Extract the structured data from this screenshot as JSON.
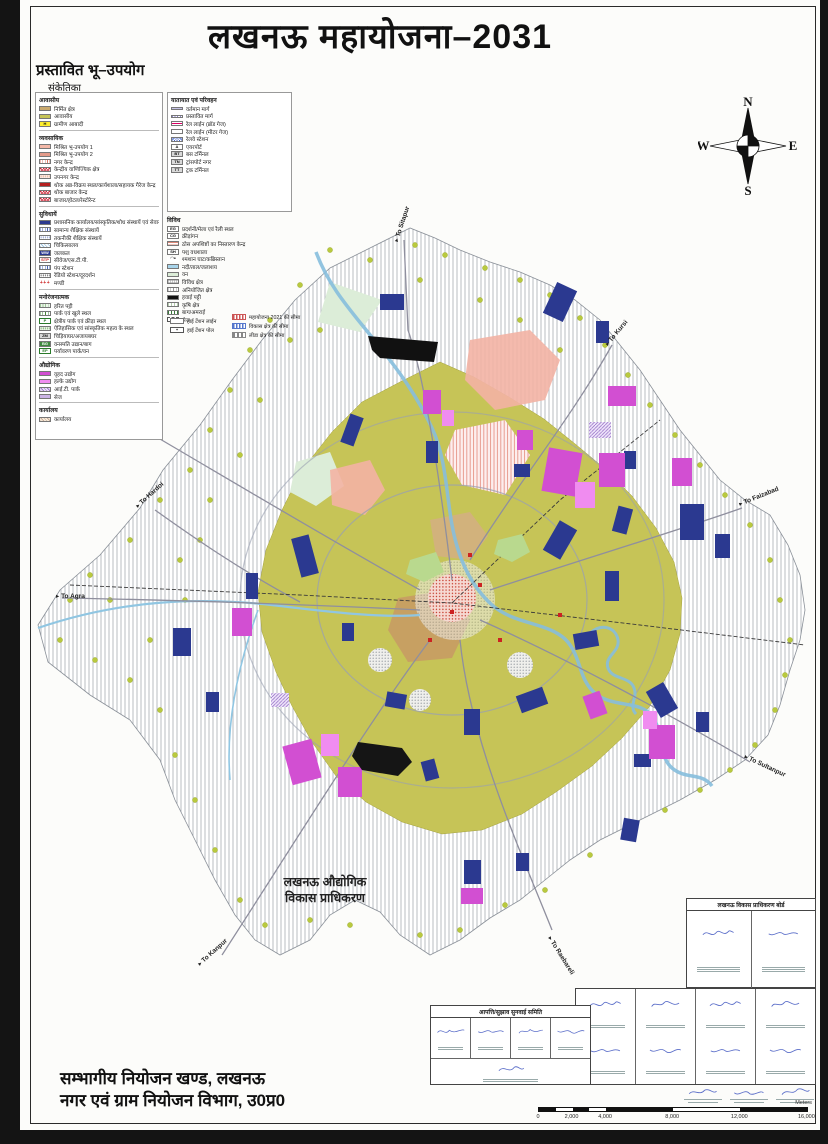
{
  "page": {
    "title": "लखनऊ महायोजना–2031",
    "subtitle": "प्रस्तावित भू–उपयोग",
    "legend_caption": "संकेतिका"
  },
  "legend_left": {
    "sections": [
      {
        "heading": "आवासीय",
        "items": [
          {
            "label": "निर्मित क्षेत्र",
            "swatch": "builtup"
          },
          {
            "label": "आवासीय",
            "swatch": "residential"
          },
          {
            "label": "ग्रामीण आबादी",
            "swatch": "lt-yellow",
            "letter": "H"
          }
        ]
      },
      {
        "heading": "व्यवसायिक",
        "items": [
          {
            "label": "मिश्रित भू-उपयोग 1",
            "swatch": "mixed1"
          },
          {
            "label": "मिश्रित भू-उपयोग 2",
            "swatch": "mixed2"
          },
          {
            "label": "नगर केन्द्र",
            "swatch": "p-hatch-pink"
          },
          {
            "label": "केन्द्रीय वाणिज्यिक क्षेत्र",
            "swatch": "p-cross-red"
          },
          {
            "label": "उपनगर केन्द्र",
            "swatch": "p-dots-pink"
          },
          {
            "label": "थोक अन्न-विक्रय स्थल/कार्यशाला/सहायक गैरेज केन्द्र",
            "swatch": "wholesale"
          },
          {
            "label": "थोक बाजार केन्द्र",
            "swatch": "p-cross-red"
          },
          {
            "label": "बाजार/होटल/रेस्टोरेन्ट",
            "swatch": "p-cross-red"
          }
        ]
      },
      {
        "heading": "सुविधायें",
        "items": [
          {
            "label": "प्रशासनिक कार्यालय/सांस्कृतिक/शोध संस्थायें एवं सेवायें",
            "swatch": "navy"
          },
          {
            "label": "सामान्य शैक्षिक संस्थायें",
            "swatch": "p-vlines-blue"
          },
          {
            "label": "तकनीकी शैक्षिक संस्थायें",
            "swatch": "p-dots-blue"
          },
          {
            "label": "चिकित्सालय",
            "swatch": "p-hatch-ltblue"
          },
          {
            "label": "जलकल",
            "swatch": "lt-navy",
            "letter": "WW"
          },
          {
            "label": "सीवेज/एस.टी.पी.",
            "swatch": "lt-stp",
            "letter": "STP"
          },
          {
            "label": "पंप स्टेशन",
            "swatch": "p-vlines-blue"
          },
          {
            "label": "रेडियो स्टेशन/दूरदर्शन",
            "swatch": "p-dots-black"
          },
          {
            "label": "मण्डी",
            "swatch": "plus-red",
            "letter": "+++"
          }
        ]
      },
      {
        "heading": "मनोरंजनात्मक",
        "items": [
          {
            "label": "हरित पट्टी",
            "swatch": "greenbelt"
          },
          {
            "label": "पार्क एवं खुले स्थल",
            "swatch": "p-vlines-green"
          },
          {
            "label": "क्षेत्रीय पार्क एवं क्रीड़ा स्थल",
            "swatch": "lt-greenb",
            "letter": "P"
          },
          {
            "label": "ऐतिहासिक एवं सांस्कृतिक महत्व के स्थल",
            "swatch": "p-dots-green"
          },
          {
            "label": "चिड़ियाघर/अजायबघर",
            "swatch": "lt-grey",
            "letter": "ZM"
          },
          {
            "label": "वनस्पति उद्यान/बाग",
            "swatch": "lt-green",
            "letter": "BG"
          },
          {
            "label": "पर्यावरण पार्क/वन",
            "swatch": "lt-greenb",
            "letter": "EP"
          }
        ]
      },
      {
        "heading": "औद्योगिक",
        "items": [
          {
            "label": "वृहद उद्योग",
            "swatch": "ind1"
          },
          {
            "label": "हल्के उद्योग",
            "swatch": "ind2"
          },
          {
            "label": "आई.टी. पार्क",
            "swatch": "p-hatch-purple"
          },
          {
            "label": "सेज",
            "swatch": "sez"
          }
        ]
      },
      {
        "heading": "कार्यालय",
        "items": [
          {
            "label": "कार्यालय",
            "swatch": "p-hatch-tan"
          }
        ]
      }
    ]
  },
  "legend_right": {
    "sections": [
      {
        "heading": "यातायात एवं परिवहन",
        "items": [
          {
            "label": "वर्तमान मार्ग",
            "swatch": "road-exist"
          },
          {
            "label": "प्रस्तावित मार्ग",
            "swatch": "road-prop"
          },
          {
            "label": "रेल लाईन (ब्रॉड गेज)",
            "swatch": "rail-broad"
          },
          {
            "label": "रेल लाईन (मीटर गेज)",
            "swatch": "rail-meter"
          },
          {
            "label": "रेलवे स्टेशन",
            "swatch": "metro-x"
          },
          {
            "label": "एयरपोर्ट",
            "swatch": "lt-white",
            "letter": "A"
          },
          {
            "label": "बस टर्मिनल",
            "swatch": "lt-grey",
            "letter": "BT"
          },
          {
            "label": "ट्रांसपोर्ट नगर",
            "swatch": "lt-grey",
            "letter": "TN"
          },
          {
            "label": "ट्रक टर्मिनल",
            "swatch": "lt-grey",
            "letter": "TT"
          }
        ]
      }
    ]
  },
  "legend_misc": {
    "sections": [
      {
        "heading": "विविध",
        "items": [
          {
            "label": "प्रदर्शनी/मेला एवं रैली स्थल",
            "swatch": "lt-white",
            "letter": "EG"
          },
          {
            "label": "क्रीड़ांगन",
            "swatch": "lt-white",
            "letter": "CG"
          },
          {
            "label": "ठोस अपशिष्टों का निस्तारण केन्द्र",
            "swatch": "p-hatch-orange"
          },
          {
            "label": "पशु वधशाला",
            "swatch": "lt-white",
            "letter": "SH"
          },
          {
            "label": "श्मशान घाट/कब्रिस्तान",
            "swatch": "cremation",
            "letter": "◠•"
          },
          {
            "label": "नदी/ताल/जलाशय",
            "swatch": "river"
          },
          {
            "label": "वन",
            "swatch": "forest"
          },
          {
            "label": "विविध क्षेत्र",
            "swatch": "p-cross-grey"
          },
          {
            "label": "अनियोजित क्षेत्र",
            "swatch": "p-vlines-grey"
          },
          {
            "label": "हवाई पट्टी",
            "swatch": "airstrip"
          },
          {
            "label": "कृषि क्षेत्र",
            "swatch": "agri"
          },
          {
            "label": "बाग/अमराई",
            "swatch": "orchard"
          },
          {
            "label": "सेज",
            "swatch": "b-dash"
          }
        ]
      }
    ]
  },
  "boundary_legend": {
    "left": [
      {
        "label": "हाई टेंशन लाईन",
        "swatch": "htline"
      },
      {
        "label": "हाई टेंशन पोल",
        "swatch": "htpole",
        "letter": "+"
      }
    ],
    "right": [
      {
        "label": "महायोजना 2021 की सीमा",
        "swatch": "b-dash-red"
      },
      {
        "label": "विकास क्षेत्र की सीमा",
        "swatch": "b-dash-blue"
      },
      {
        "label": "लीडा क्षेत्र की सीमा",
        "swatch": "b-dash-grey"
      }
    ]
  },
  "compass": {
    "n": "N",
    "e": "E",
    "s": "S",
    "w": "W"
  },
  "map": {
    "area_label_line1": "लखनऊ औद्योगिक",
    "area_label_line2": "विकास प्राधिकरण",
    "road_labels": [
      {
        "text": "To Sitapur",
        "x": 398,
        "y": 242,
        "rot": -72
      },
      {
        "text": "To Kursi",
        "x": 608,
        "y": 346,
        "rot": -50
      },
      {
        "text": "To Faizabad",
        "x": 740,
        "y": 506,
        "rot": -22
      },
      {
        "text": "To Sultanpur",
        "x": 744,
        "y": 758,
        "rot": 25
      },
      {
        "text": "To Raebareli",
        "x": 548,
        "y": 938,
        "rot": 58
      },
      {
        "text": "To Kanpur",
        "x": 200,
        "y": 966,
        "rot": -42
      },
      {
        "text": "To Agra",
        "x": 56,
        "y": 598,
        "rot": 0
      },
      {
        "text": "To Hardoi",
        "x": 138,
        "y": 508,
        "rot": -42
      }
    ]
  },
  "tables": {
    "committee_header": "आपत्ति/सुझाव सुनवाई समिति",
    "board_header": "लखनऊ विकास प्राधिकरण बोर्ड"
  },
  "scalebar": {
    "ticks": [
      "0",
      "2,000",
      "4,000",
      "8,000",
      "12,000",
      "16,000"
    ],
    "values": [
      0,
      2000,
      4000,
      8000,
      12000,
      16000
    ],
    "max": 16000,
    "unit": "Meters"
  },
  "footer": {
    "line1": "सम्भागीय नियोजन खण्ड, लखनऊ",
    "line2": "नगर एवं ग्राम नियोजन विभाग, उ0प्र0"
  },
  "colors": {
    "residential_olive": "#c6c457",
    "industrial_magenta": "#d24fd2",
    "facility_navy": "#2b3990",
    "river_blue": "#86bedd",
    "airstrip_black": "#111111"
  }
}
